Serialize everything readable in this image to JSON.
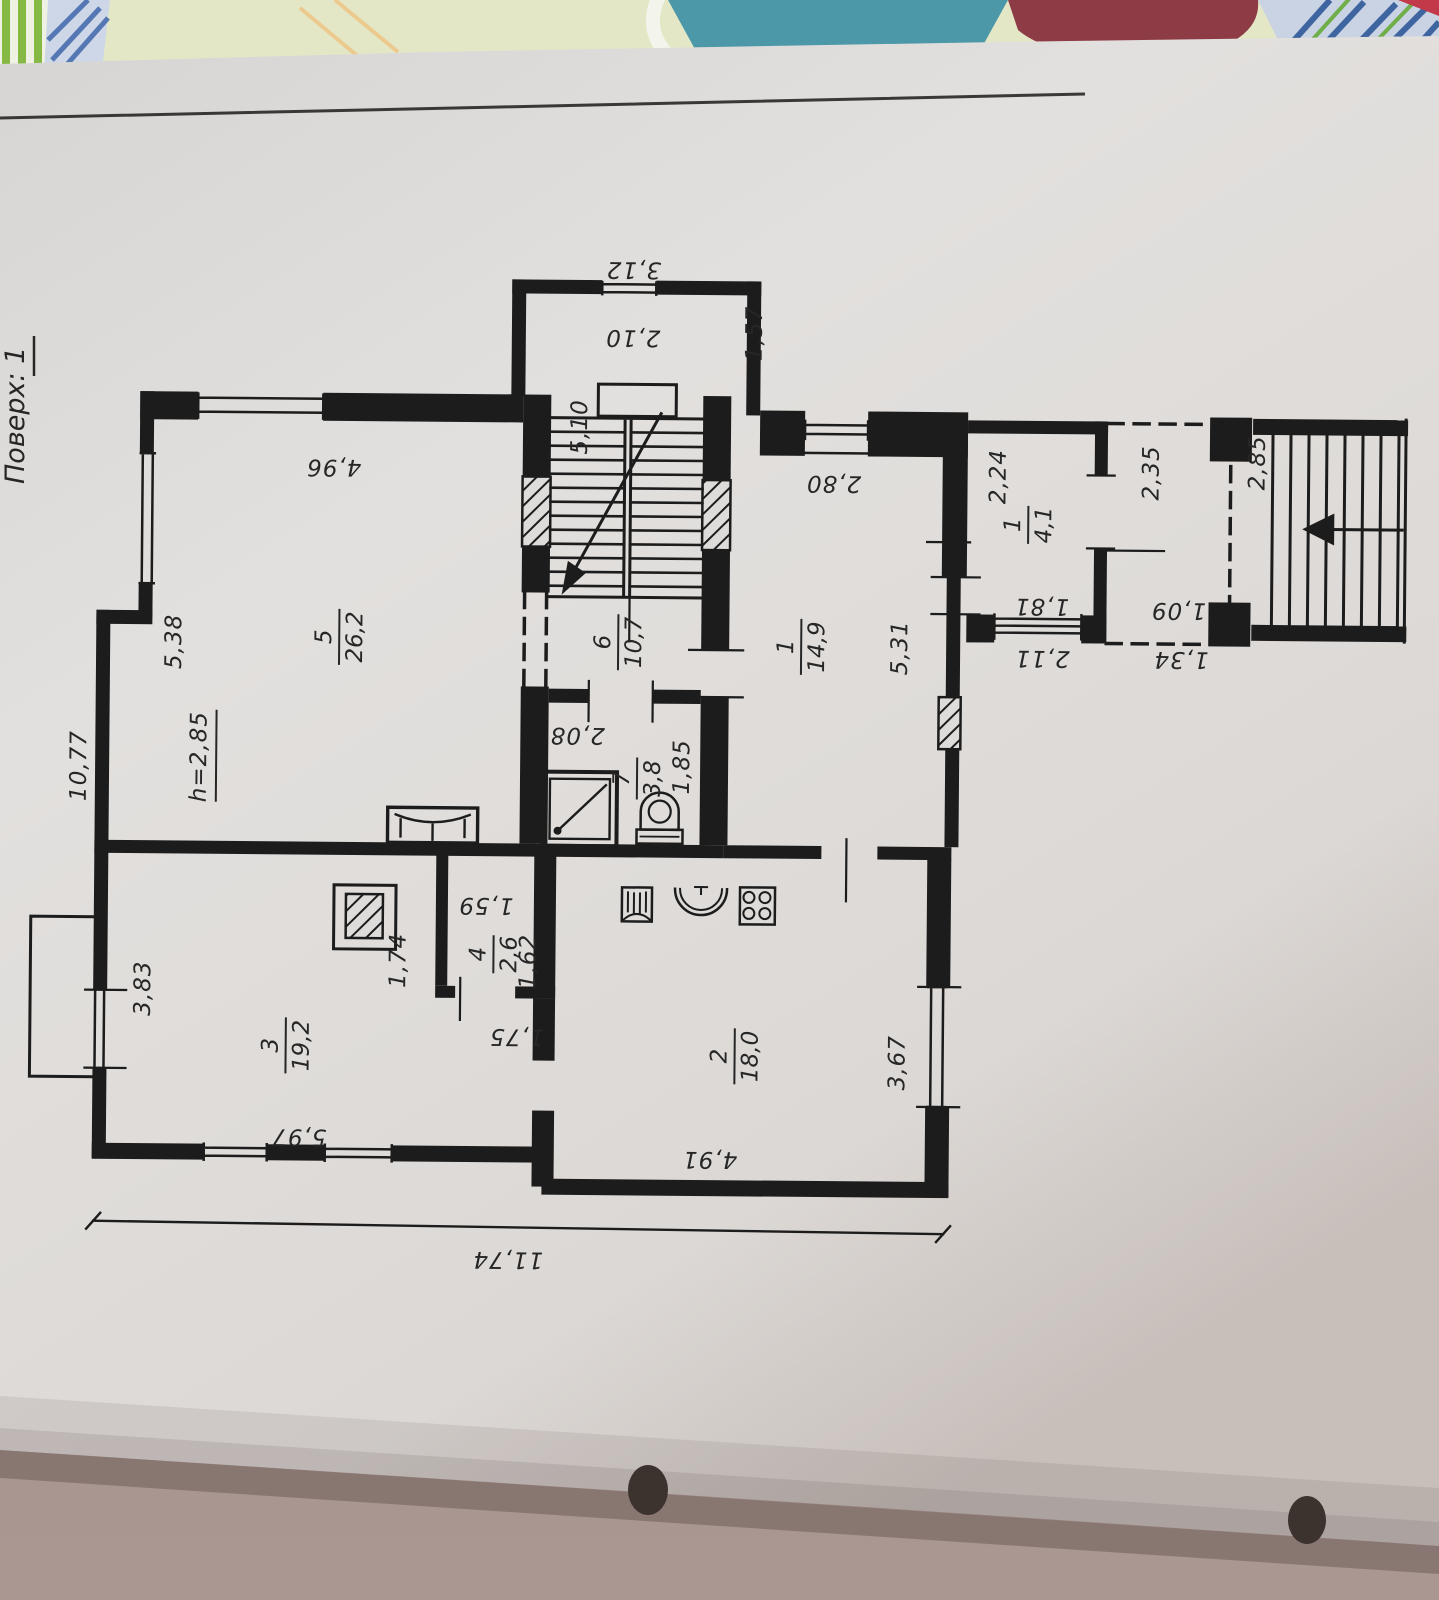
{
  "photo": {
    "floor_label": "Поверх: 1",
    "colors": {
      "paper": "#dedcda",
      "ink": "#1c1c1c",
      "table": "#a08c86",
      "fabric_teal": "#4d98a8",
      "fabric_maroon": "#8d3b45",
      "fabric_green": "#86b944"
    }
  },
  "rooms": {
    "living": {
      "num": "5",
      "area": "26,2"
    },
    "hall": {
      "num": "6",
      "area": "10,7"
    },
    "bathroom": {
      "num": "7",
      "area": "3,8"
    },
    "bedroom": {
      "num": "1",
      "area": "14,9"
    },
    "vestibule": {
      "num": "1",
      "area": "4,1"
    },
    "kitchen": {
      "num": "2",
      "area": "18,0"
    },
    "room3": {
      "num": "3",
      "area": "19,2"
    },
    "pantry": {
      "num": "4",
      "area": "2,6"
    },
    "ceiling_height": "h=2,85"
  },
  "dimensions": {
    "bay_width": "3,12",
    "landing": "2,10",
    "stairwell": "5,10",
    "bay_side": "1,57",
    "living_width": "4,96",
    "living_depth": "5,38",
    "left_total": "10,77",
    "bedroom_width": "2,80",
    "bedroom_depth": "5,31",
    "vestibule_side": "2,24",
    "vestibule_inner": "1,81",
    "vestibule_outer": "2,11",
    "porch_depth": "2,35",
    "porch_inner": "1,09",
    "porch_outer": "1,34",
    "ext_stairs": "2,85",
    "bath_width": "2,08",
    "bath_depth": "1,85",
    "nook": "1,74",
    "pantry_width": "1,59",
    "pantry_depth": "1,62",
    "pantry_door": "1,75",
    "room3_side": "3,83",
    "room3_width": "5,97",
    "kitchen_width": "4,91",
    "kitchen_depth": "3,67",
    "total_width": "11,74"
  }
}
